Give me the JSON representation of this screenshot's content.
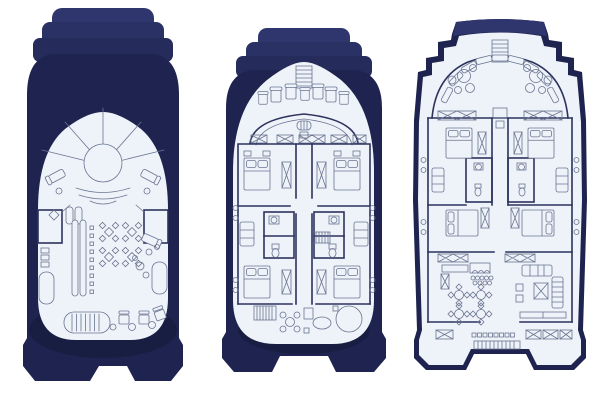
{
  "canvas": {
    "width": 600,
    "height": 400,
    "background": "#ffffff"
  },
  "colors": {
    "background": "#ffffff",
    "hull_cap": "#2f366e",
    "hull_step1": "#2a3165",
    "hull_step2": "#252c5b",
    "hull_body": "#1e244f",
    "hull_shadow": "#181d42",
    "interior": "#eef2f9",
    "line": "#6a7590",
    "wall": "#2c335e"
  },
  "figure": {
    "type": "yacht-deck-plans",
    "views": [
      {
        "id": "sun-deck-plan",
        "position": "left",
        "features": [
          "radial-bow-lounge",
          "jacuzzi",
          "curved-benches",
          "sun-loungers",
          "wet-bar",
          "bar-stools",
          "cafe-tables",
          "storage-lockers",
          "grill",
          "deck-chairs",
          "side-sunpads"
        ]
      },
      {
        "id": "upper-deck-plan",
        "position": "center",
        "features": [
          "bow-ladder",
          "helm-seats",
          "windshield",
          "helm-console",
          "skylight-hatches",
          "double-cabins",
          "wardrobes",
          "bathrooms",
          "companionway-stairs",
          "aft-stairs",
          "aft-tables",
          "side-deck-chairs"
        ]
      },
      {
        "id": "main-deck-plan",
        "position": "right",
        "features": [
          "bow-ladder",
          "bow-bench-seating",
          "cocktail-tables",
          "helm-console",
          "double-cabins",
          "wardrobes",
          "bathrooms",
          "dining-salon",
          "galley-counter",
          "bar-stools",
          "lounge-sofa",
          "armchair",
          "chaise",
          "tv-cabinet",
          "aft-bench-seating",
          "swim-platform"
        ]
      }
    ]
  }
}
